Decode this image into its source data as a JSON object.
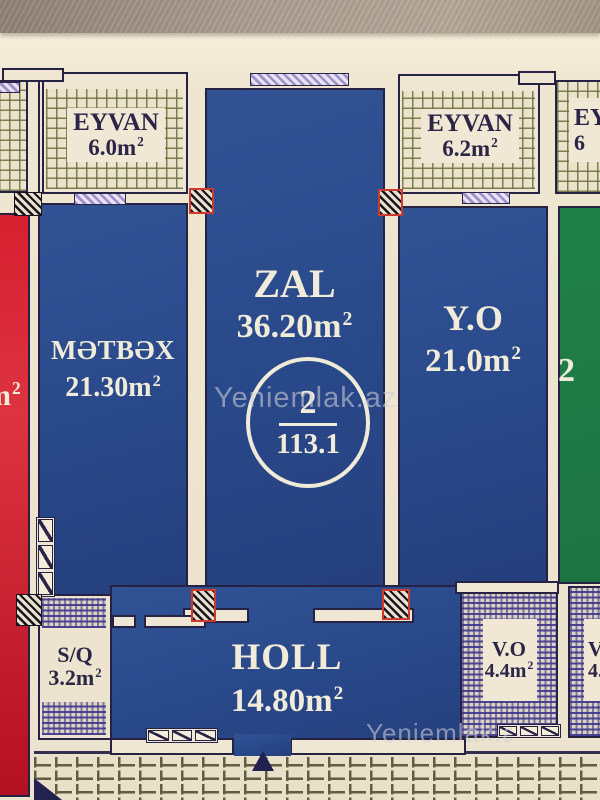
{
  "photo": {
    "watermark_center": "Yeniemlak.az",
    "watermark_bottom": "Yeniemlak.az"
  },
  "units": {
    "base": "m",
    "sup": "2"
  },
  "badge": {
    "flat_number": "2",
    "total_area": "113.1"
  },
  "rooms": {
    "eyvan_left": {
      "name": "EYVAN",
      "area": "6.0"
    },
    "eyvan_right": {
      "name": "EYVAN",
      "area": "6.2"
    },
    "eyvan_far_right": {
      "name": "EY",
      "area": "6"
    },
    "metbex": {
      "name": "MƏTBƏX",
      "area": "21.30"
    },
    "zal": {
      "name": "ZAL",
      "area": "36.20"
    },
    "yo": {
      "name": "Y.O",
      "area": "21.0"
    },
    "holl": {
      "name": "HOLL",
      "area": "14.80"
    },
    "sq": {
      "name": "S/Q",
      "area": "3.2"
    },
    "vo": {
      "name": "V.O",
      "area": "4.4"
    },
    "vo_right": {
      "name": "V",
      "area": "4."
    },
    "red_left_fragment": {
      "unit": "m"
    },
    "green_right_fragment": {
      "digit": "2"
    }
  },
  "colors": {
    "room_blue": "#2a4a8c",
    "room_red": "#d41f2e",
    "room_green": "#1e7845",
    "hatch_purple": "#40388c",
    "hatch_olive": "#6a6e3c",
    "window_lavender": "#9d90cc",
    "paper_cream": "#efe6d1",
    "wall_dark": "#262243",
    "text_light": "#f1ebd9",
    "text_dark": "#2c2547"
  }
}
